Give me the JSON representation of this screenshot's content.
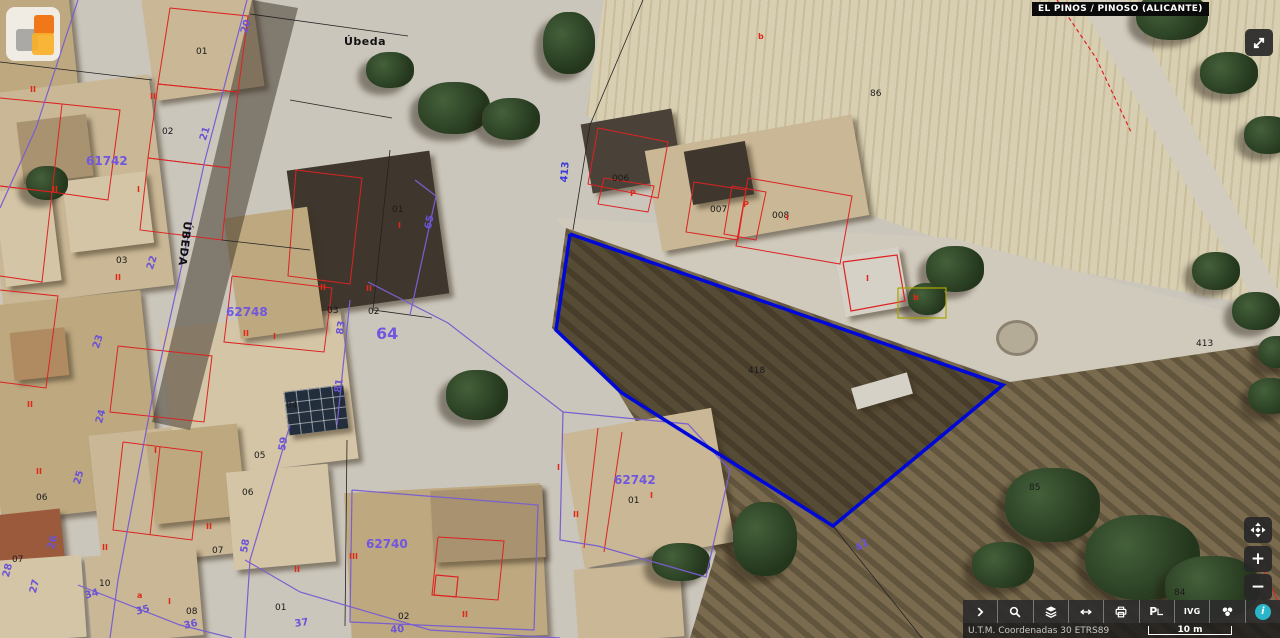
{
  "header": {
    "municipality_label": "EL PINOS / PINOSO (ALICANTE)",
    "logo_icon": "catastro-logo",
    "logo_colors": {
      "orange": "#f07818",
      "amber": "#f8b028",
      "gray": "#7d7d7d"
    }
  },
  "controls": {
    "expand_button": {
      "icon": "expand-arrows-icon"
    },
    "zoom": [
      {
        "name": "pan",
        "icon": "pan-compass-icon",
        "label": ""
      },
      {
        "name": "zoom-in",
        "icon": "plus-icon",
        "label": "+"
      },
      {
        "name": "zoom-out",
        "icon": "minus-icon",
        "label": "−"
      }
    ]
  },
  "toolbar": {
    "buttons": [
      {
        "name": "expand-toolbar",
        "icon": "chevron-right-icon",
        "label": ""
      },
      {
        "name": "search",
        "icon": "search-icon",
        "label": ""
      },
      {
        "name": "layers",
        "icon": "layers-icon",
        "label": ""
      },
      {
        "name": "measure",
        "icon": "horizontal-arrows-icon",
        "label": ""
      },
      {
        "name": "print",
        "icon": "printer-icon",
        "label": ""
      },
      {
        "name": "street-view",
        "icon": "p-pointer-icon",
        "label": "P"
      },
      {
        "name": "ivg",
        "icon": "text-label",
        "label": "IVG"
      },
      {
        "name": "basemap",
        "icon": "wheel-icon",
        "label": ""
      },
      {
        "name": "info",
        "icon": "info-icon",
        "label": "i"
      }
    ]
  },
  "statusbar": {
    "projection": "U.T.M. Coordenadas 30 ETRS89",
    "scale_label": "10 m"
  },
  "map": {
    "selected_parcel_color": "#0008d8",
    "labels": [
      {
        "t": "Úbeda",
        "x": 344,
        "y": 36,
        "cls": "name"
      },
      {
        "t": "ÚBEDA",
        "x": 193,
        "y": 222,
        "cls": "name",
        "r": 97
      },
      {
        "t": "01",
        "x": 196,
        "y": 48,
        "cls": "blk"
      },
      {
        "t": "02",
        "x": 162,
        "y": 128,
        "cls": "blk"
      },
      {
        "t": "03",
        "x": 116,
        "y": 257,
        "cls": "blk"
      },
      {
        "t": "03",
        "x": 327,
        "y": 307,
        "cls": "blk"
      },
      {
        "t": "02",
        "x": 368,
        "y": 308,
        "cls": "blk"
      },
      {
        "t": "01",
        "x": 392,
        "y": 206,
        "cls": "blk"
      },
      {
        "t": "04",
        "x": 286,
        "y": 402,
        "cls": "blk"
      },
      {
        "t": "05",
        "x": 254,
        "y": 452,
        "cls": "blk"
      },
      {
        "t": "06",
        "x": 242,
        "y": 489,
        "cls": "blk"
      },
      {
        "t": "06",
        "x": 36,
        "y": 494,
        "cls": "blk"
      },
      {
        "t": "07",
        "x": 12,
        "y": 556,
        "cls": "blk"
      },
      {
        "t": "07",
        "x": 212,
        "y": 547,
        "cls": "blk"
      },
      {
        "t": "10",
        "x": 99,
        "y": 580,
        "cls": "blk"
      },
      {
        "t": "08",
        "x": 186,
        "y": 608,
        "cls": "blk"
      },
      {
        "t": "01",
        "x": 275,
        "y": 604,
        "cls": "blk"
      },
      {
        "t": "02",
        "x": 398,
        "y": 613,
        "cls": "blk"
      },
      {
        "t": "01",
        "x": 628,
        "y": 497,
        "cls": "blk"
      },
      {
        "t": "006",
        "x": 612,
        "y": 175,
        "cls": "blk"
      },
      {
        "t": "007",
        "x": 710,
        "y": 206,
        "cls": "blk"
      },
      {
        "t": "008",
        "x": 772,
        "y": 212,
        "cls": "blk"
      },
      {
        "t": "86",
        "x": 870,
        "y": 90,
        "cls": "blk"
      },
      {
        "t": "418",
        "x": 748,
        "y": 367,
        "cls": "blk"
      },
      {
        "t": "85",
        "x": 1029,
        "y": 484,
        "cls": "blk"
      },
      {
        "t": "84",
        "x": 1174,
        "y": 589,
        "cls": "blk"
      },
      {
        "t": "413",
        "x": 1196,
        "y": 340,
        "cls": "blk"
      },
      {
        "t": "61742",
        "x": 86,
        "y": 155,
        "cls": "purb"
      },
      {
        "t": "62748",
        "x": 226,
        "y": 306,
        "cls": "purb"
      },
      {
        "t": "62740",
        "x": 366,
        "y": 538,
        "cls": "purb"
      },
      {
        "t": "62742",
        "x": 614,
        "y": 474,
        "cls": "purb"
      },
      {
        "t": "64",
        "x": 376,
        "y": 326,
        "cls": "purb p64"
      },
      {
        "t": "20",
        "x": 240,
        "y": 32,
        "cls": "pur",
        "r": -72
      },
      {
        "t": "21",
        "x": 199,
        "y": 139,
        "cls": "pur",
        "r": -72
      },
      {
        "t": "22",
        "x": 146,
        "y": 268,
        "cls": "pur",
        "r": -72
      },
      {
        "t": "23",
        "x": 92,
        "y": 347,
        "cls": "pur",
        "r": -72
      },
      {
        "t": "24",
        "x": 95,
        "y": 422,
        "cls": "pur",
        "r": -74
      },
      {
        "t": "25",
        "x": 73,
        "y": 483,
        "cls": "pur",
        "r": -74
      },
      {
        "t": "26",
        "x": 47,
        "y": 548,
        "cls": "pur",
        "r": -76
      },
      {
        "t": "27",
        "x": 29,
        "y": 592,
        "cls": "pur",
        "r": -76
      },
      {
        "t": "28",
        "x": 2,
        "y": 576,
        "cls": "pur",
        "r": -76
      },
      {
        "t": "34",
        "x": 84,
        "y": 592,
        "cls": "pur",
        "r": -16
      },
      {
        "t": "35",
        "x": 135,
        "y": 608,
        "cls": "pur",
        "r": -15
      },
      {
        "t": "36",
        "x": 183,
        "y": 622,
        "cls": "pur",
        "r": -13
      },
      {
        "t": "37",
        "x": 294,
        "y": 620,
        "cls": "pur",
        "r": -9
      },
      {
        "t": "40",
        "x": 390,
        "y": 626,
        "cls": "pur",
        "r": -5
      },
      {
        "t": "42",
        "x": 854,
        "y": 546,
        "cls": "pur",
        "r": -35
      },
      {
        "t": "58",
        "x": 240,
        "y": 552,
        "cls": "pur",
        "r": -80
      },
      {
        "t": "59",
        "x": 278,
        "y": 450,
        "cls": "pur",
        "r": -80
      },
      {
        "t": "83",
        "x": 336,
        "y": 334,
        "cls": "pur",
        "r": -82
      },
      {
        "t": "81",
        "x": 334,
        "y": 392,
        "cls": "pur",
        "r": -82
      },
      {
        "t": "65",
        "x": 424,
        "y": 228,
        "cls": "pur",
        "r": -78
      },
      {
        "t": "413",
        "x": 560,
        "y": 182,
        "cls": "blu",
        "r": -85
      },
      {
        "t": "II",
        "x": 150,
        "y": 93,
        "cls": "red"
      },
      {
        "t": "I",
        "x": 137,
        "y": 186,
        "cls": "red"
      },
      {
        "t": "II",
        "x": 115,
        "y": 274,
        "cls": "red"
      },
      {
        "t": "II",
        "x": 30,
        "y": 86,
        "cls": "red"
      },
      {
        "t": "II",
        "x": 52,
        "y": 186,
        "cls": "red"
      },
      {
        "t": "II",
        "x": 27,
        "y": 401,
        "cls": "red"
      },
      {
        "t": "I",
        "x": 398,
        "y": 222,
        "cls": "red"
      },
      {
        "t": "II",
        "x": 366,
        "y": 285,
        "cls": "red"
      },
      {
        "t": "II",
        "x": 243,
        "y": 330,
        "cls": "red"
      },
      {
        "t": "I",
        "x": 273,
        "y": 333,
        "cls": "red"
      },
      {
        "t": "II",
        "x": 320,
        "y": 284,
        "cls": "red"
      },
      {
        "t": "III",
        "x": 349,
        "y": 553,
        "cls": "red"
      },
      {
        "t": "II",
        "x": 294,
        "y": 566,
        "cls": "red"
      },
      {
        "t": "II",
        "x": 462,
        "y": 611,
        "cls": "red"
      },
      {
        "t": "I",
        "x": 557,
        "y": 464,
        "cls": "red"
      },
      {
        "t": "II",
        "x": 573,
        "y": 511,
        "cls": "red"
      },
      {
        "t": "I",
        "x": 650,
        "y": 492,
        "cls": "red"
      },
      {
        "t": "II",
        "x": 36,
        "y": 468,
        "cls": "red"
      },
      {
        "t": "II",
        "x": 206,
        "y": 523,
        "cls": "red"
      },
      {
        "t": "II",
        "x": 102,
        "y": 544,
        "cls": "red"
      },
      {
        "t": "I",
        "x": 168,
        "y": 598,
        "cls": "red"
      },
      {
        "t": "I",
        "x": 154,
        "y": 447,
        "cls": "red"
      },
      {
        "t": "a",
        "x": 137,
        "y": 592,
        "cls": "red"
      },
      {
        "t": "P",
        "x": 630,
        "y": 190,
        "cls": "red"
      },
      {
        "t": "P",
        "x": 743,
        "y": 201,
        "cls": "red"
      },
      {
        "t": "I",
        "x": 786,
        "y": 214,
        "cls": "red"
      },
      {
        "t": "I",
        "x": 866,
        "y": 275,
        "cls": "red"
      },
      {
        "t": "b",
        "x": 758,
        "y": 33,
        "cls": "red"
      },
      {
        "t": "b",
        "x": 913,
        "y": 294,
        "cls": "red"
      }
    ],
    "polylines": [
      {
        "c": "#d22",
        "w": 1,
        "p": "170,8 248,16 238,92 158,84 170,8"
      },
      {
        "c": "#d22",
        "w": 1,
        "p": "158,84 238,92 230,168 148,158 158,84"
      },
      {
        "c": "#d22",
        "w": 1,
        "p": "148,158 230,168 222,240 140,230 148,158"
      },
      {
        "c": "#d22",
        "w": 1,
        "p": "0,98 62,104 52,192 0,186"
      },
      {
        "c": "#d22",
        "w": 1,
        "p": "0,186 52,192 42,282 0,276"
      },
      {
        "c": "#d22",
        "w": 1,
        "p": "62,104 120,110 108,200 52,192"
      },
      {
        "c": "#d22",
        "w": 1,
        "p": "0,290 58,296 46,388 0,382"
      },
      {
        "c": "#d22",
        "w": 1,
        "p": "118,346 212,356 204,422 110,412 118,346"
      },
      {
        "c": "#d22",
        "w": 1,
        "p": "232,276 332,288 324,352 224,342 232,276"
      },
      {
        "c": "#d22",
        "w": 1,
        "p": "296,170 362,178 350,284 288,276 296,170"
      },
      {
        "c": "#d22",
        "w": 1,
        "p": "598,128 668,142 658,198 588,184 598,128"
      },
      {
        "c": "#d22",
        "w": 1,
        "p": "604,178 654,186 648,212 598,204 604,178"
      },
      {
        "c": "#d22",
        "w": 1,
        "p": "694,182 746,190 738,240 686,232 694,182"
      },
      {
        "c": "#d22",
        "w": 1,
        "p": "748,178 852,196 840,264 736,246 748,178"
      },
      {
        "c": "#d22",
        "w": 1,
        "p": "732,186 766,192 756,240 724,234 732,186"
      },
      {
        "c": "#d22",
        "w": 1.2,
        "p": "843,262 897,255 905,301 851,311 843,262"
      },
      {
        "c": "#d22",
        "w": 1,
        "p": "438,537 504,541 498,600 432,595 438,537"
      },
      {
        "c": "#d22",
        "w": 1.2,
        "p": "436,575 458,577 456,597 434,595 436,575"
      },
      {
        "c": "#d22",
        "w": 1,
        "p": "598,428 584,548"
      },
      {
        "c": "#d22",
        "w": 1,
        "p": "622,432 604,552"
      },
      {
        "c": "#d22",
        "w": 1,
        "p": "123,442 202,452 192,540 113,530 123,442"
      },
      {
        "c": "#d22",
        "w": 1,
        "p": "160,447 150,535"
      },
      {
        "c": "#d22",
        "w": 1.2,
        "d": "4 3",
        "p": "1057,0 1096,58 1132,134"
      },
      {
        "c": "#d22",
        "w": 1,
        "p": "1256,554 1280,606"
      },
      {
        "c": "#222",
        "w": 0.8,
        "p": "643,0 590,125 573,230"
      },
      {
        "c": "#222",
        "w": 0.8,
        "p": "833,526 922,638"
      },
      {
        "c": "#222",
        "w": 0.8,
        "p": "250,14 408,36"
      },
      {
        "c": "#222",
        "w": 0.8,
        "p": "390,150 373,310"
      },
      {
        "c": "#222",
        "w": 0.8,
        "p": "373,310 432,318"
      },
      {
        "c": "#222",
        "w": 0.8,
        "p": "347,440 345,626"
      },
      {
        "c": "#222",
        "w": 0.8,
        "p": "0,62 152,80"
      },
      {
        "c": "#222",
        "w": 0.8,
        "p": "290,100 392,118"
      },
      {
        "c": "#222",
        "w": 0.8,
        "p": "222,240 310,250"
      },
      {
        "c": "#7a5fd0",
        "w": 1.2,
        "p": "247,0 205,160 152,400 118,580 110,638"
      },
      {
        "c": "#7a5fd0",
        "w": 1.2,
        "p": "78,0 36,128 0,208"
      },
      {
        "c": "#7a5fd0",
        "w": 1.2,
        "p": "290,425 250,560 245,638"
      },
      {
        "c": "#7a5fd0",
        "w": 1.2,
        "p": "245,560 300,592 430,630 560,638"
      },
      {
        "c": "#7a5fd0",
        "w": 1.2,
        "p": "78,585 180,625 232,638"
      },
      {
        "c": "#7a5fd0",
        "w": 1.2,
        "p": "563,412 688,424 730,470 706,577 598,546 560,540 563,412"
      },
      {
        "c": "#7a5fd0",
        "w": 1.2,
        "p": "352,490 538,505 534,630 350,622 352,490"
      },
      {
        "c": "#7a5fd0",
        "w": 1.2,
        "p": "350,300 337,425"
      },
      {
        "c": "#7a5fd0",
        "w": 1.2,
        "p": "415,180 436,196 410,315"
      },
      {
        "c": "#7a5fd0",
        "w": 1.2,
        "p": "368,282 448,323 563,412"
      },
      {
        "c": "#a8a400",
        "w": 1.2,
        "p": "898,288 946,288 946,318 898,318 898,288"
      },
      {
        "c": "#0008d8",
        "w": 3.5,
        "p": "570,234 1003,385 833,526 622,393 556,330 570,234"
      }
    ]
  }
}
